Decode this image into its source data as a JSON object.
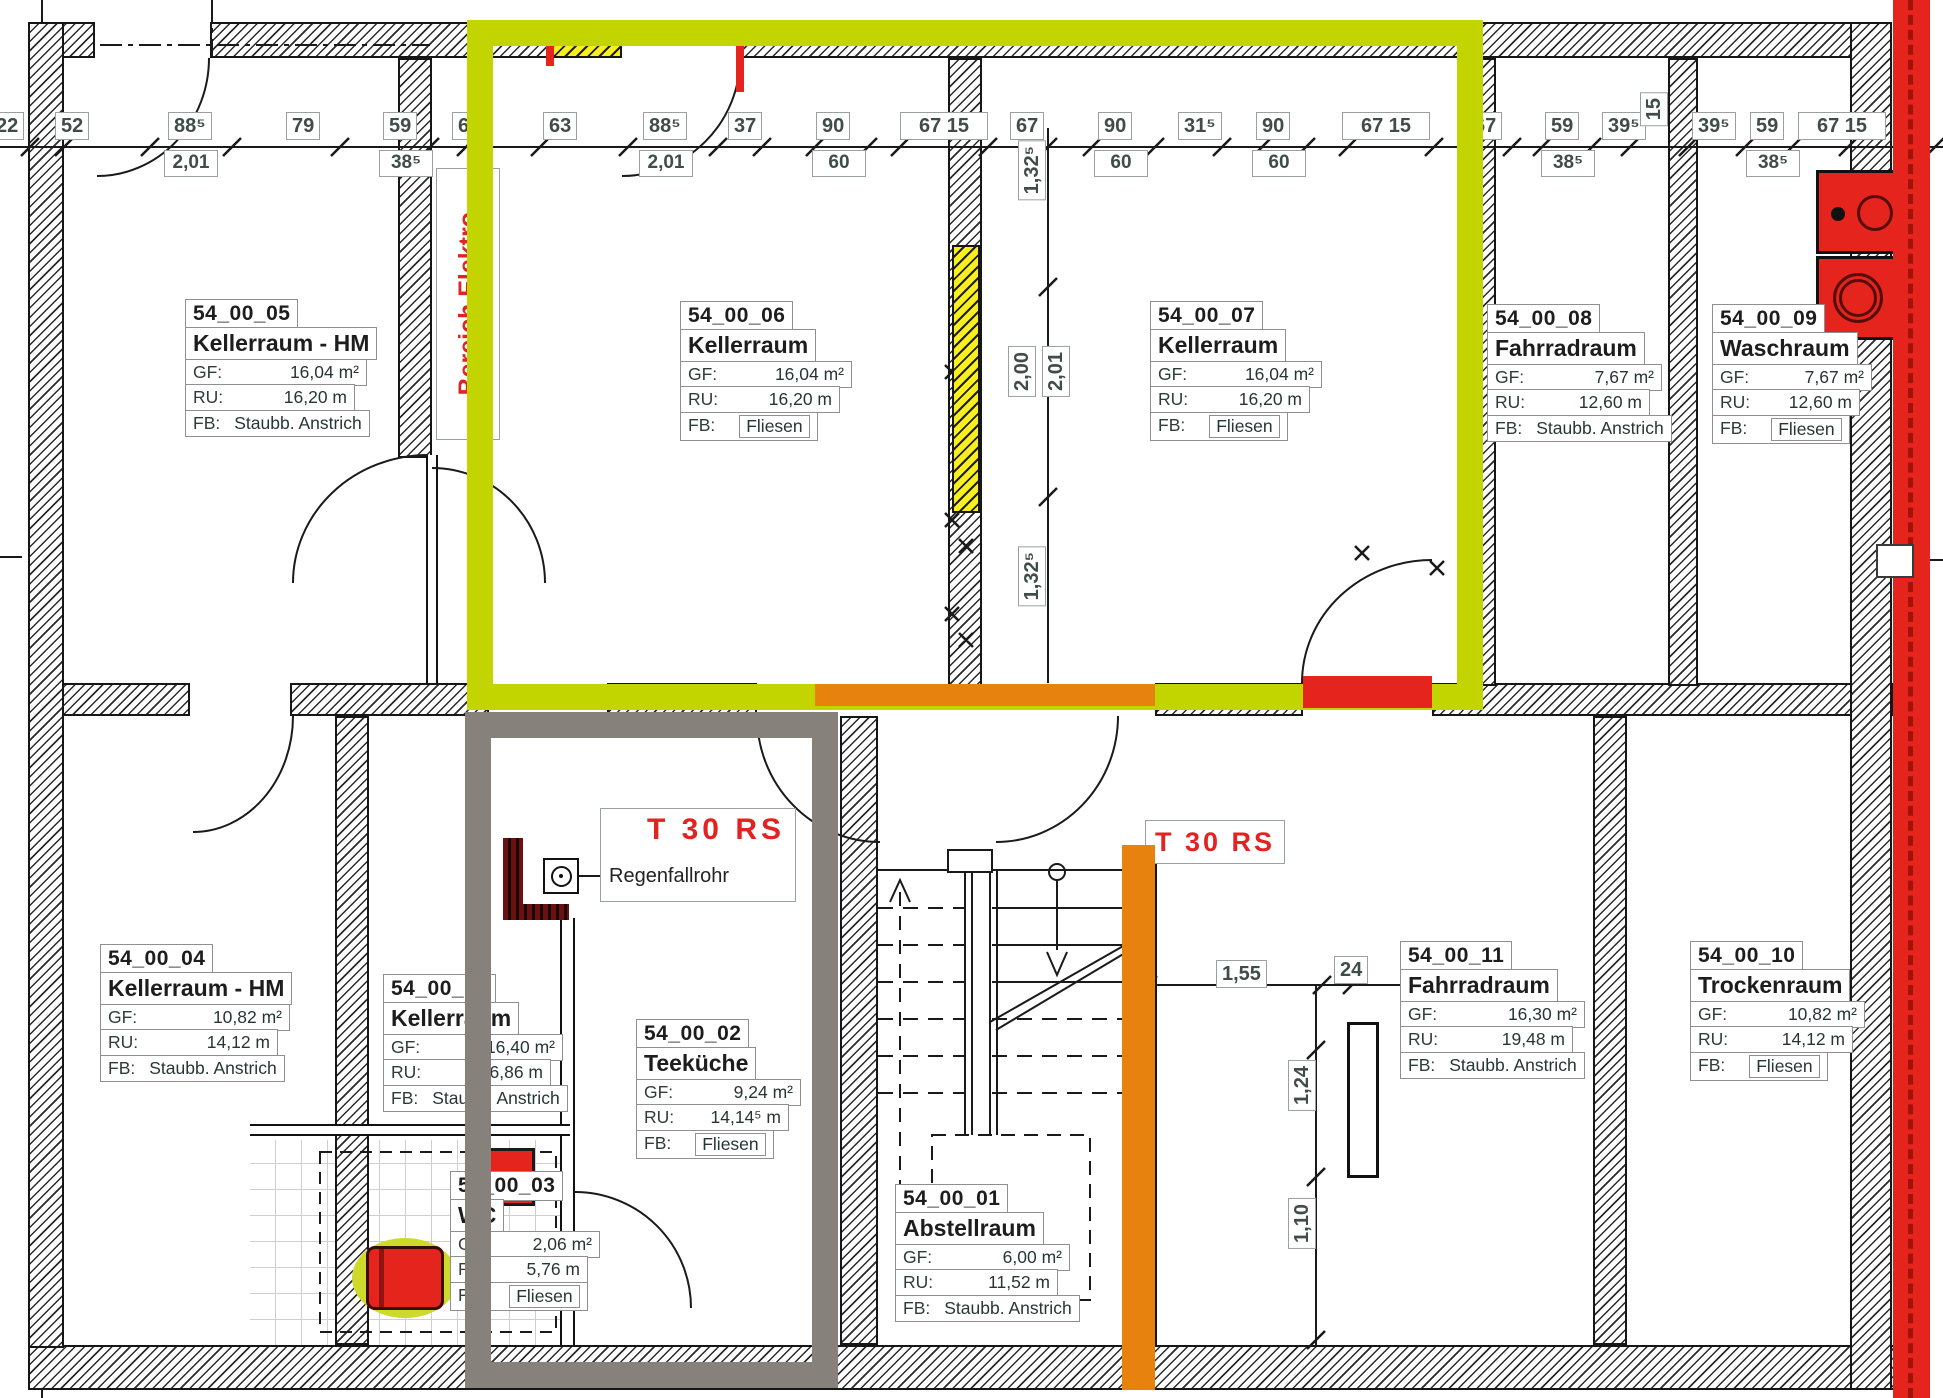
{
  "title": "Kellergeschoss Grundriss",
  "colors": {
    "highlight_green": "#c3d501",
    "highlight_gray": "#87817b",
    "stripe_orange": "#e8820e",
    "stripe_red": "#e5241e",
    "wall_yellow": "#f9ee1e",
    "fire_text_red": "#e32222"
  },
  "annotations": {
    "bereich_elektro": "Bereich Elektro",
    "t30rs_1": "T 30 RS",
    "regenfallrohr": "Regenfallrohr",
    "t30rs_2": "T 30 RS"
  },
  "field_labels": {
    "gf": "GF:",
    "ru": "RU:",
    "fb": "FB:"
  },
  "rooms": [
    {
      "id": "54_00_05",
      "name": "Kellerraum - HM",
      "gf": "16,04 m²",
      "ru": "16,20 m",
      "fb": "Staubb. Anstrich",
      "fb_boxed": false,
      "x": 185,
      "y": 300,
      "w": 182
    },
    {
      "id": "54_00_06",
      "name": "Kellerraum",
      "gf": "16,04 m²",
      "ru": "16,20 m",
      "fb": "Fliesen",
      "fb_boxed": true,
      "x": 680,
      "y": 302,
      "w": 172
    },
    {
      "id": "54_00_07",
      "name": "Kellerraum",
      "gf": "16,04 m²",
      "ru": "16,20 m",
      "fb": "Fliesen",
      "fb_boxed": true,
      "x": 1150,
      "y": 302,
      "w": 172
    },
    {
      "id": "54_00_08",
      "name": "Fahrradraum",
      "gf": "7,67 m²",
      "ru": "12,60 m",
      "fb": "Staubb. Anstrich",
      "fb_boxed": false,
      "x": 1487,
      "y": 305,
      "w": 175
    },
    {
      "id": "54_00_09",
      "name": "Waschraum",
      "gf": "7,67 m²",
      "ru": "12,60 m",
      "fb": "Fliesen",
      "fb_boxed": true,
      "x": 1712,
      "y": 305,
      "w": 160
    },
    {
      "id": "54_00_04",
      "name": "Kellerraum - HM",
      "gf": "10,82 m²",
      "ru": "14,12 m",
      "fb": "Staubb. Anstrich",
      "fb_boxed": false,
      "x": 100,
      "y": 945,
      "w": 190
    },
    {
      "id": "54_00_12",
      "name": "Kellerraum",
      "gf": "16,40 m²",
      "ru": "16,86 m",
      "fb": "Staubb. Anstrich",
      "fb_boxed": false,
      "x": 383,
      "y": 975,
      "w": 180
    },
    {
      "id": "54_00_02",
      "name": "Teeküche",
      "gf": "9,24 m²",
      "ru": "14,14⁵ m",
      "fb": "Fliesen",
      "fb_boxed": true,
      "x": 636,
      "y": 1020,
      "w": 165
    },
    {
      "id": "54_00_03",
      "name": "WC",
      "gf": "2,06 m²",
      "ru": "5,76 m",
      "fb": "Fliesen",
      "fb_boxed": true,
      "x": 450,
      "y": 1172,
      "w": 150
    },
    {
      "id": "54_00_01",
      "name": "Abstellraum",
      "gf": "6,00 m²",
      "ru": "11,52 m",
      "fb": "Staubb. Anstrich",
      "fb_boxed": false,
      "x": 895,
      "y": 1185,
      "w": 175
    },
    {
      "id": "54_00_11",
      "name": "Fahrradraum",
      "gf": "16,30 m²",
      "ru": "19,48 m",
      "fb": "Staubb. Anstrich",
      "fb_boxed": false,
      "x": 1400,
      "y": 942,
      "w": 185
    },
    {
      "id": "54_00_10",
      "name": "Trockenraum",
      "gf": "10,82 m²",
      "ru": "14,12 m",
      "fb": "Fliesen",
      "fb_boxed": true,
      "x": 1690,
      "y": 942,
      "w": 175
    }
  ],
  "dims_top": [
    {
      "v": "22",
      "x": -10
    },
    {
      "v": "52",
      "x": 55
    },
    {
      "v": "88⁵",
      "x": 168,
      "sub": "2,01"
    },
    {
      "v": "79",
      "x": 286
    },
    {
      "v": "59",
      "x": 383,
      "sub": "38⁵"
    },
    {
      "v": "67",
      "x": 452
    },
    {
      "v": "63",
      "x": 543
    },
    {
      "v": "88⁵",
      "x": 643,
      "sub": "2,01"
    },
    {
      "v": "37",
      "x": 728
    },
    {
      "v": "90",
      "x": 816,
      "sub": "60"
    },
    {
      "v": "67 15",
      "x": 900,
      "w": 88
    },
    {
      "v": "67",
      "x": 1010
    },
    {
      "v": "90",
      "x": 1098,
      "sub": "60"
    },
    {
      "v": "31⁵",
      "x": 1178
    },
    {
      "v": "90",
      "x": 1256,
      "sub": "60"
    },
    {
      "v": "67 15",
      "x": 1342,
      "w": 88
    },
    {
      "v": "67",
      "x": 1468
    },
    {
      "v": "59",
      "x": 1545,
      "sub": "38⁵"
    },
    {
      "v": "39⁵",
      "x": 1602
    },
    {
      "v": "39⁵",
      "x": 1692
    },
    {
      "v": "59",
      "x": 1750,
      "sub": "38⁵"
    },
    {
      "v": "67 15",
      "x": 1798,
      "w": 88
    }
  ],
  "dims_other": [
    {
      "v": "1,55",
      "x": 1216,
      "y": 960
    },
    {
      "v": "24",
      "x": 1334,
      "y": 956
    }
  ],
  "dims_rotated": [
    {
      "v": "1,32⁵",
      "x": 1018,
      "y": 140
    },
    {
      "v": "2,00",
      "x": 1008,
      "y": 346
    },
    {
      "v": "2,01",
      "x": 1042,
      "y": 346
    },
    {
      "v": "1,32⁵",
      "x": 1018,
      "y": 546
    },
    {
      "v": "15",
      "x": 1640,
      "y": 92
    },
    {
      "v": "1,24",
      "x": 1288,
      "y": 1060
    },
    {
      "v": "1,10",
      "x": 1288,
      "y": 1198
    }
  ]
}
